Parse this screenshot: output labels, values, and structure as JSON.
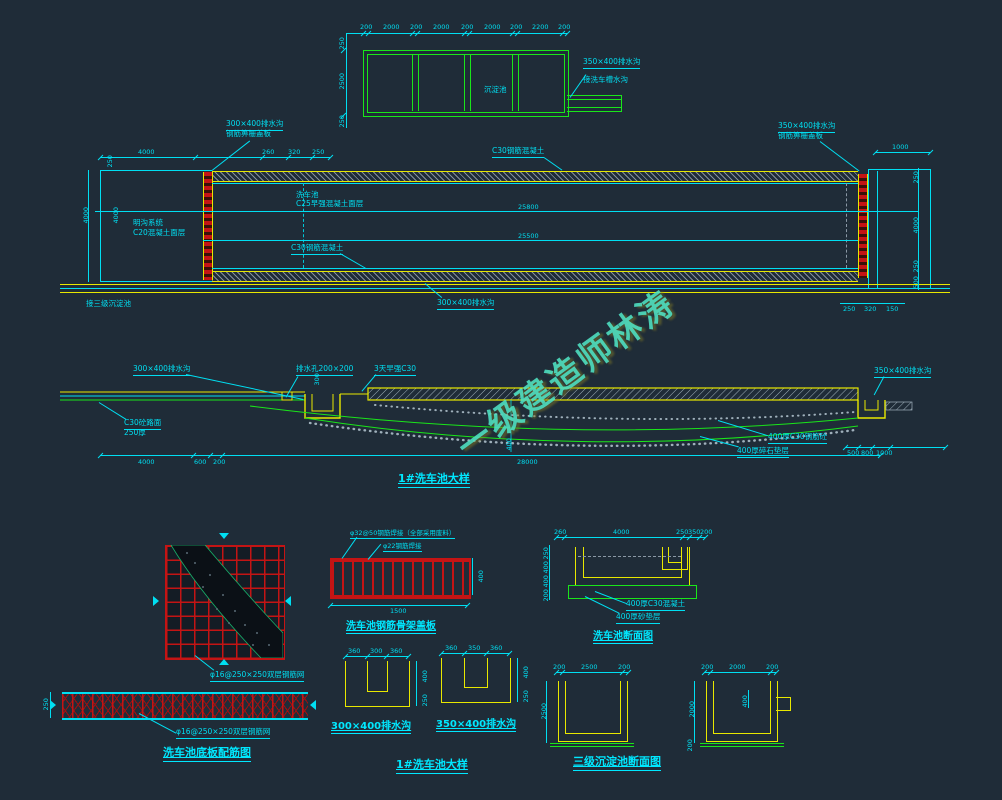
{
  "watermark": {
    "text": "一级建造师林涛"
  },
  "colors": {
    "bg": "#1f2c38",
    "cyan": "#00dff2",
    "green": "#1ae61a",
    "yellow": "#e8e800",
    "red": "#c41414"
  },
  "tank_plan": {
    "center_label": "沉淀池",
    "top_dims": [
      "200",
      "2000",
      "200",
      "2000",
      "200",
      "2000",
      "200",
      "2200",
      "200"
    ],
    "left_dims": [
      "250",
      "2500",
      "250"
    ],
    "drain_label": "350×400排水沟",
    "connect_label": "接洗车槽水沟"
  },
  "pool_plan": {
    "top_dims": [
      "4000",
      "260",
      "320",
      "250"
    ],
    "dim_1000": "1000",
    "drain_tl_1": "300×400排水沟",
    "drain_tl_2": "钢筋箅栅盖板",
    "c30_top": "C30钢筋混凝土",
    "drain_tr_1": "350×400排水沟",
    "drain_tr_2": "钢筋箅栅盖板",
    "pool_1": "洗车池",
    "pool_2": "C25早强混凝土面层",
    "gutter_1": "明沟系统",
    "gutter_2": "C20混凝土面层",
    "c30_bottom": "C30钢筋混凝土",
    "length_1": "25800",
    "length_2": "25500",
    "left_dim_top": "250",
    "left_dim_1": "4000",
    "left_dim_2": "4000",
    "right_dims": [
      "250",
      "4000",
      "250",
      "500"
    ],
    "bottom_right_dims": [
      "250",
      "320",
      "150"
    ],
    "connect_label": "接三级沉淀池",
    "drain_bottom": "300×400排水沟"
  },
  "section": {
    "drain_left": "300×400排水沟",
    "dim_300": "300",
    "drain_hole": "排水孔200×200",
    "slope_note": "3天早强C30",
    "road_1": "C30砼路面",
    "road_2": "250厚",
    "drain_right": "350×400排水沟",
    "base_1": "400厚C30钢筋砼",
    "base_2": "400厚碎石垫层",
    "dim_400": "400",
    "bottom_dims": [
      "4000",
      "600",
      "200",
      "28000"
    ],
    "right_dims": [
      "500",
      "800",
      "1000"
    ],
    "title": "1#洗车池大样"
  },
  "slab_detail": {
    "mesh_note_top": "φ16@250×250双层钢筋网",
    "mesh_note_bottom": "φ16@250×250双层钢筋网",
    "dim_250": "250",
    "title": "洗车池底板配筋图"
  },
  "skeleton_detail": {
    "note_1": "φ32@50钢筋焊接（全部采用废料）",
    "note_2": "φ22钢筋焊接",
    "dim_width": "1500",
    "dim_height": "400",
    "title": "洗车池钢筋骨架盖板"
  },
  "pool_section": {
    "top_dims": [
      "260",
      "4000",
      "250",
      "350",
      "200"
    ],
    "left_dims": [
      "250",
      "400",
      "400",
      "200"
    ],
    "note_1": "400厚C30混凝土",
    "note_2": "400厚砂垫层",
    "title": "洗车池断面图"
  },
  "channel_300": {
    "top_dims": [
      "360",
      "300",
      "360"
    ],
    "right_dims": [
      "400",
      "250"
    ],
    "label": "300×400排水沟"
  },
  "channel_350": {
    "top_dims": [
      "360",
      "350",
      "360"
    ],
    "right_dims": [
      "400",
      "250"
    ],
    "label": "350×400排水沟"
  },
  "detail_title": "1#洗车池大样",
  "sediment_section": {
    "left_top_dims": [
      "200",
      "2500",
      "200"
    ],
    "left_side_dim": "2500",
    "right_top_dims": [
      "200",
      "2000",
      "200"
    ],
    "right_side_dim": "2000",
    "right_bottom_dim": "200",
    "notch_dim": "400",
    "title": "三级沉淀池断面图"
  }
}
